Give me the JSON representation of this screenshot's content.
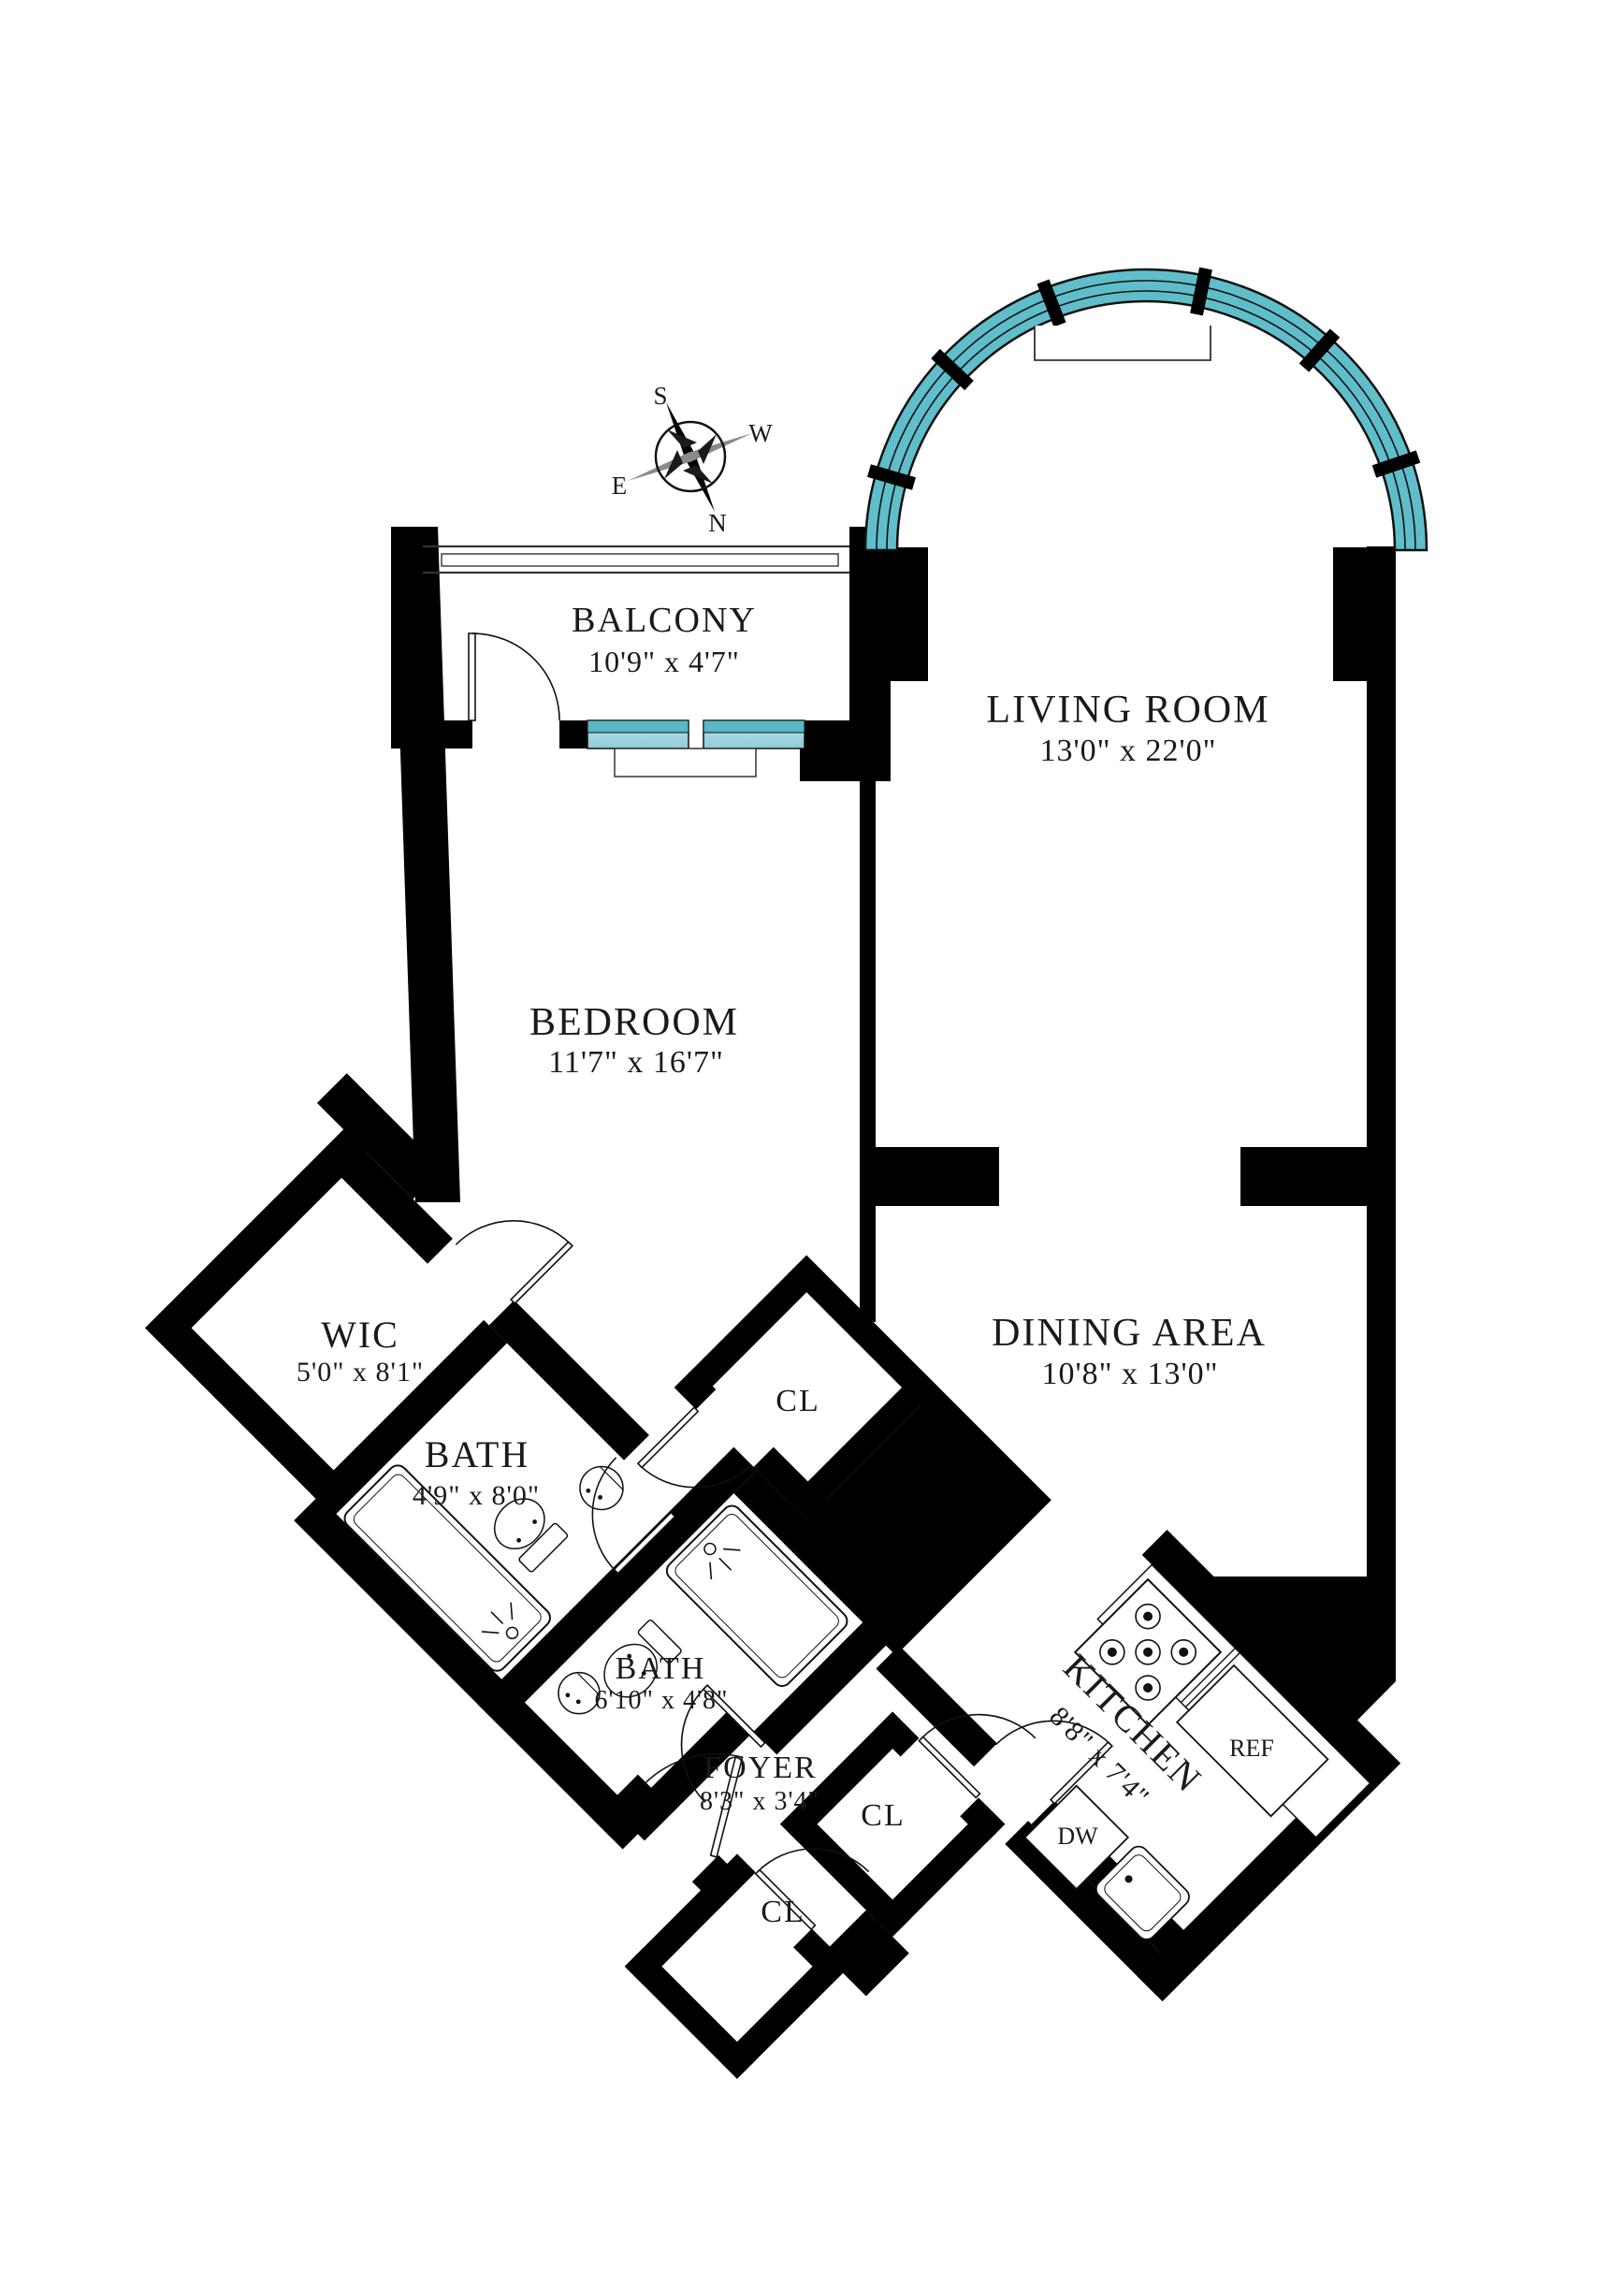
{
  "title": "Apartment floor plan",
  "compass": {
    "s": "S",
    "w": "W",
    "e": "E",
    "n": "N"
  },
  "rooms": {
    "balcony": {
      "name": "BALCONY",
      "dims": "10'9\" x 4'7\""
    },
    "living": {
      "name": "LIVING ROOM",
      "dims": "13'0\" x 22'0\""
    },
    "bedroom": {
      "name": "BEDROOM",
      "dims": "11'7\" x 16'7\""
    },
    "dining": {
      "name": "DINING AREA",
      "dims": "10'8\" x 13'0\""
    },
    "wic": {
      "name": "WIC",
      "dims": "5'0\" x 8'1\""
    },
    "bath1": {
      "name": "BATH",
      "dims": "4'9\" x 8'0\""
    },
    "bath2": {
      "name": "BATH",
      "dims": "6'10\" x 4'8\""
    },
    "foyer": {
      "name": "FOYER",
      "dims": "8'3\" x 3'4\""
    },
    "kitchen": {
      "name": "KITCHEN",
      "dims": "8'8\" x 7'4\""
    },
    "closet_bedroom": {
      "name": "CL"
    },
    "closet_foyer_upper": {
      "name": "CL"
    },
    "closet_foyer_lower": {
      "name": "CL"
    }
  },
  "appliances": {
    "refrigerator": "REF",
    "dishwasher": "DW"
  },
  "colors": {
    "wall": "#000000",
    "window_teal": "#5fbeca",
    "window_teal_light": "#a9d9e2",
    "line": "#1a1a1a"
  }
}
